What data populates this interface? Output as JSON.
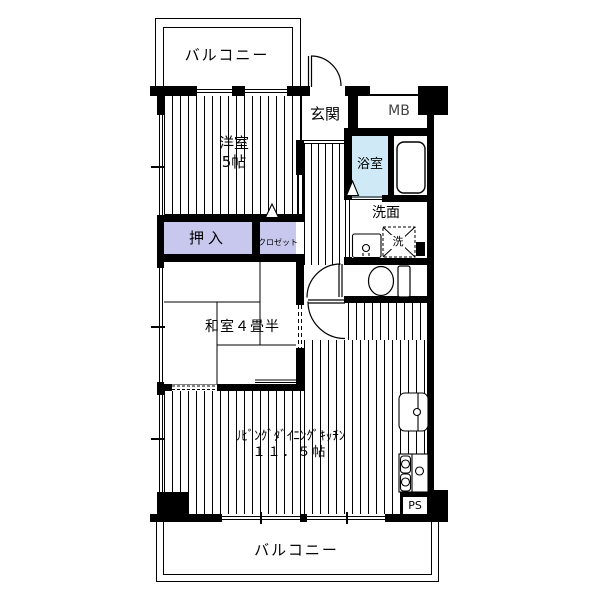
{
  "colors": {
    "wall": "#000000",
    "closet_fill": "#c8c8ee",
    "bath_fill": "#cfeaf6"
  },
  "rooms": {
    "balcony_top": {
      "label": "バルコニー"
    },
    "western_room": {
      "label": "洋室",
      "size": "5帖"
    },
    "entrance": {
      "label": "玄関"
    },
    "meter_box": {
      "label": "MB"
    },
    "bathroom": {
      "label": "浴室"
    },
    "washroom": {
      "label": "洗面"
    },
    "washing_machine": {
      "label": "洗"
    },
    "oshiire": {
      "label": "押入"
    },
    "closet": {
      "label": "クロゼット"
    },
    "japanese_room": {
      "label": "和室４畳半"
    },
    "ldk": {
      "label": "ﾘﾋﾞﾝｸﾞﾀﾞｲﾆﾝｸﾞｷｯﾁﾝ",
      "size": "１１．５帖"
    },
    "pipe_space": {
      "label": "PS"
    },
    "balcony_bottom": {
      "label": "バルコニー"
    }
  }
}
